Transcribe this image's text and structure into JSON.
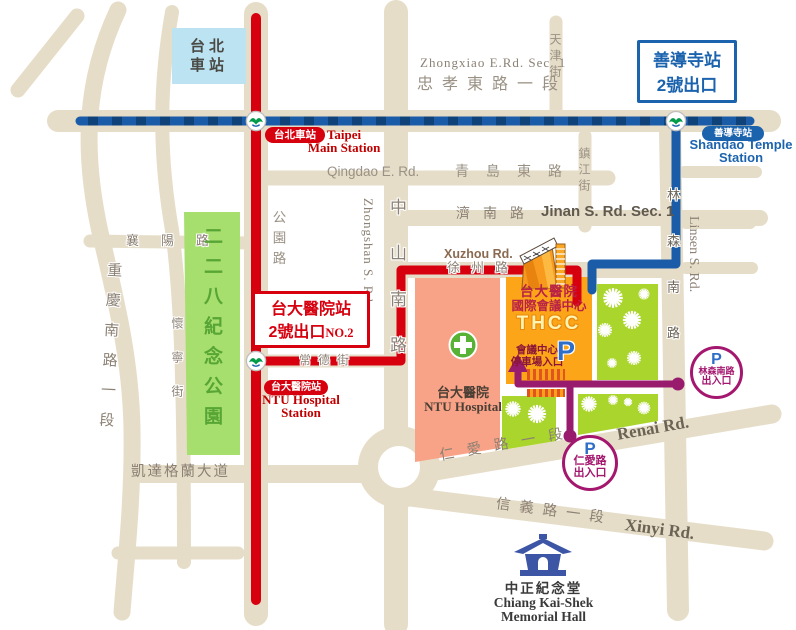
{
  "colors": {
    "road": "#E6DDC8",
    "mrt_red_line": "#D7000F",
    "mrt_blue_line": "#1A5CA8",
    "walk_route_purple": "#981B6D",
    "park_green": "#A7DF6E",
    "park_lime": "#A9D52C",
    "hospital_salmon": "#F8A287",
    "thcc_orange": "#FCA519",
    "station_building_blue": "#BCE3F2",
    "parking_p_blue": "#2E6DC8"
  },
  "stations": {
    "taipei_main": {
      "building_line1": "台北",
      "building_line2": "車站",
      "badge": "台北車站",
      "en_line1": "Taipei",
      "en_line2": "Main Station"
    },
    "shandao": {
      "badge": "善導寺站",
      "en_line1": "Shandao Temple",
      "en_line2": "Station",
      "exit_line1": "善導寺站",
      "exit_line2": "2號出口"
    },
    "ntu": {
      "badge": "台大醫院站",
      "en_line1": "NTU Hospital",
      "en_line2": "Station",
      "exit_line1": "台大醫院站",
      "exit_line2": "2號出口",
      "exit_no": "NO.2"
    }
  },
  "roads": {
    "zhongxiao_en": "Zhongxiao E.Rd. Sec. 1",
    "zhongxiao_zh": "忠孝東路一段",
    "qingdao_en": "Qingdao E. Rd.",
    "qingdao_zh": "青島東路",
    "jinan_zh": "濟南路",
    "jinan_en": "Jinan S. Rd. Sec. 1",
    "xuzhou_en": "Xuzhou Rd.",
    "xuzhou_zh": "徐州路",
    "changde_zh": "常德街",
    "tianjin_zh": "天津街",
    "zhenjiang_zh": "鎮江街",
    "gongyuan_zh": "公園路",
    "zhongshan_zh": "中山南路",
    "zhongshan_en": "Zhongshan S. Rd.",
    "linsen_zh": "林森南路",
    "linsen_en": "Linsen S. Rd.",
    "chongqing_zh": "重慶南路一段",
    "huaining_zh": "懷寧街",
    "xiangyang_zh": "襄陽路",
    "ketagalan_zh": "凱達格蘭大道",
    "renai_zh": "仁愛路一段",
    "renai_en": "Renai Rd.",
    "xinyi_zh": "信義路一段",
    "xinyi_en": "Xinyi Rd."
  },
  "places": {
    "park228": "二二八紀念公園",
    "hospital_zh": "台大醫院",
    "hospital_en": "NTU Hospital",
    "thcc_line1": "台大醫院",
    "thcc_line2": "國際會議中心",
    "thcc_acronym": "THCC",
    "thcc_parking_line1": "會議中心",
    "thcc_parking_line2": "停車場入口",
    "thcc_p": "P",
    "cks_zh": "中正紀念堂",
    "cks_en_line1": "Chiang Kai-Shek",
    "cks_en_line2": "Memorial Hall"
  },
  "parking": {
    "p": "P",
    "linsen_line1": "林森南路",
    "linsen_line2": "出入口",
    "renai_line1": "仁愛路",
    "renai_line2": "出入口"
  }
}
